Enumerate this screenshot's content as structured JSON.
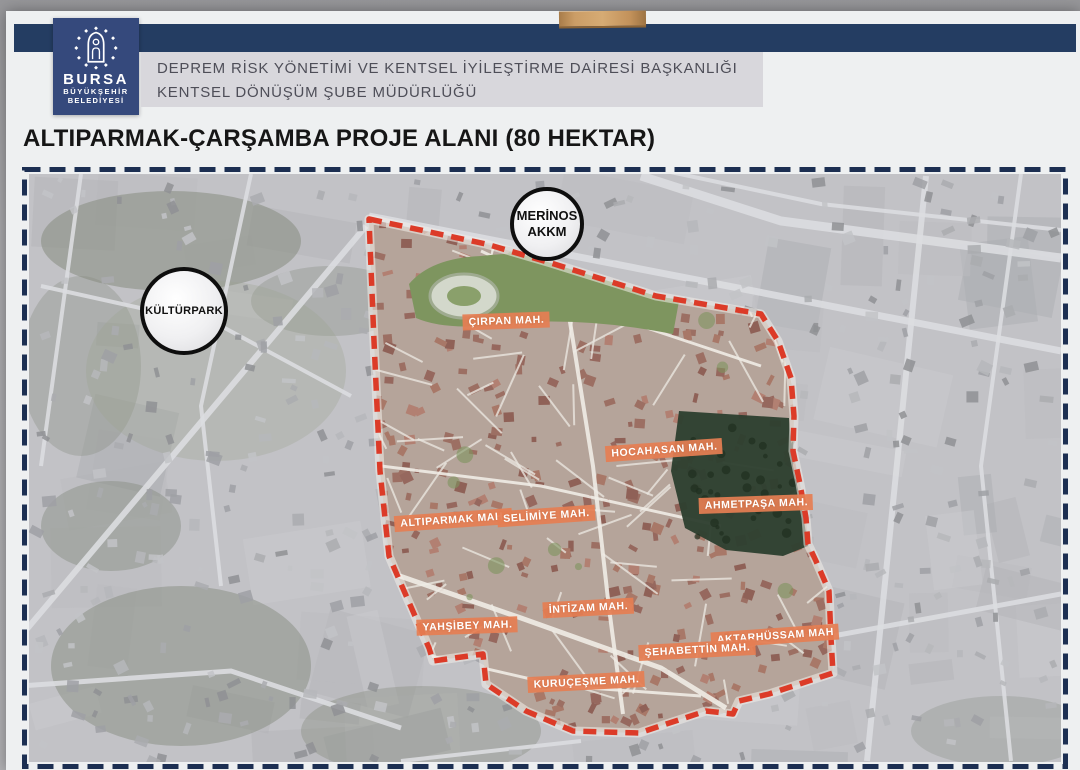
{
  "header": {
    "logo": {
      "line1": "BURSA",
      "line2": "BÜYÜKŞEHİR",
      "line3": "BELEDİYESİ"
    },
    "department_line1": "DEPREM RİSK YÖNETİMİ VE KENTSEL İYİLEŞTİRME DAİRESİ BAŞKANLIĞI",
    "department_line2": "KENTSEL DÖNÜŞÜM ŞUBE MÜDÜRLÜĞÜ"
  },
  "title": "ALTIPARMAK-ÇARŞAMBA PROJE ALANI (80 HEKTAR)",
  "map": {
    "landmarks": [
      {
        "name": "Merinos AKKM",
        "line1": "MERİNOS",
        "line2": "AKKM"
      },
      {
        "name": "Kültürpark",
        "line1": "KÜLTÜRPARK"
      }
    ],
    "districts": [
      {
        "label": "ÇIRPAN MAH."
      },
      {
        "label": "HOCAHASAN MAH."
      },
      {
        "label": "AHMETPAŞA MAH."
      },
      {
        "label": "ALTIPARMAK MAH."
      },
      {
        "label": "SELİMİYE MAH."
      },
      {
        "label": "İNTİZAM MAH."
      },
      {
        "label": "YAHŞİBEY MAH."
      },
      {
        "label": "AKTARHÜSSAM MAH"
      },
      {
        "label": "ŞEHABETTİN MAH."
      },
      {
        "label": "KURUÇEŞME MAH."
      }
    ],
    "colors": {
      "boundary": "#dc3b28",
      "district_label_bg": "#e57e53",
      "frame_dash": "#1c2f52",
      "header_bar": "#243d62",
      "logo_bg": "#35497c"
    }
  }
}
